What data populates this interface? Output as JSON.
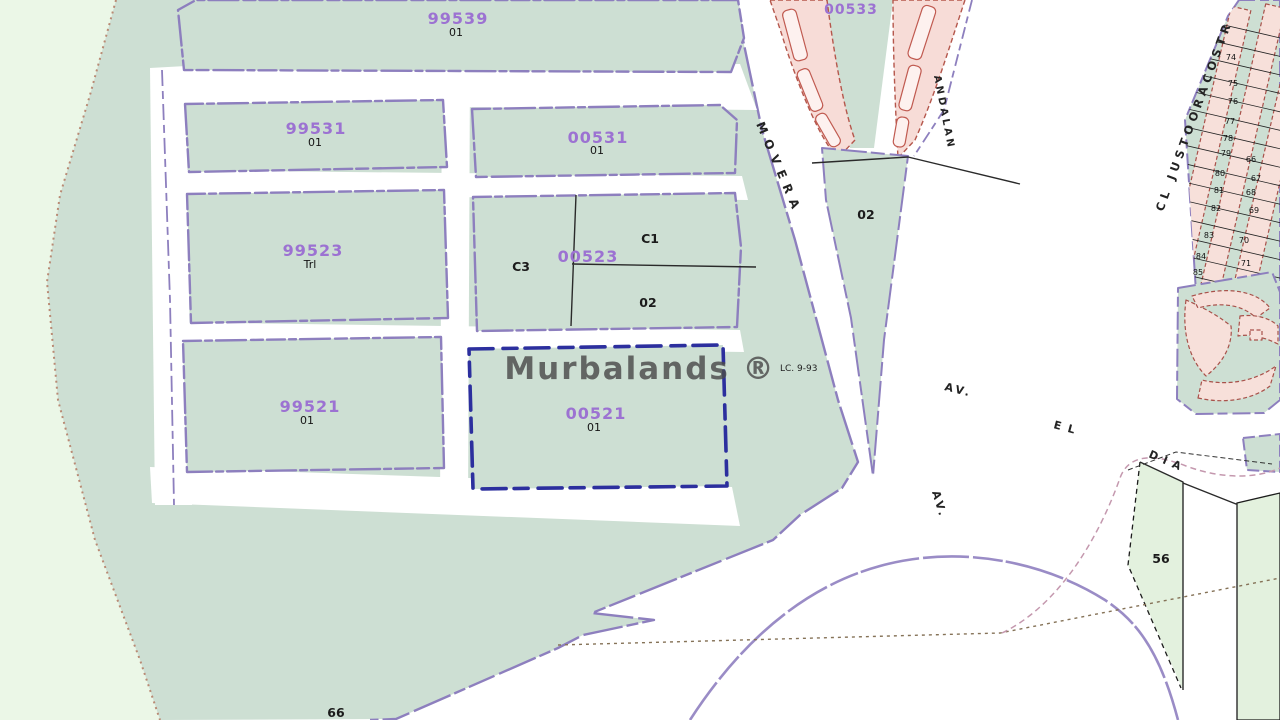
{
  "watermark": "Murbalands ®",
  "annotation": {
    "lc_note": "LC. 9-93"
  },
  "blocks": {
    "b99539": {
      "id": "99539",
      "sub": "01"
    },
    "b99531": {
      "id": "99531",
      "sub": "01"
    },
    "b00531": {
      "id": "00531",
      "sub": "01"
    },
    "b99523": {
      "id": "99523",
      "sub": "Trl"
    },
    "b00523": {
      "id": "00523",
      "parts": {
        "c1": "C1",
        "c3": "C3",
        "p02": "02"
      }
    },
    "b99521": {
      "id": "99521",
      "sub": "01"
    },
    "b00521": {
      "id": "00521",
      "sub": "01"
    },
    "b00533": {
      "id": "00533"
    }
  },
  "labels": {
    "wedge02": "02",
    "parcel56": "56",
    "parcel66": "66"
  },
  "streets": {
    "movera": "MOVERA",
    "andalan": "ANDALAN",
    "justo": "CL JUSTOORACOSTR",
    "av_upper": "AV.",
    "el": "EL",
    "dia": "DIA",
    "av_lower": "AV."
  },
  "grid_parcel_numbers": [
    {
      "t": "74",
      "x": 1231,
      "y": 60
    },
    {
      "t": "75",
      "x": 1233,
      "y": 86
    },
    {
      "t": "76",
      "x": 1233,
      "y": 104
    },
    {
      "t": "77",
      "x": 1230,
      "y": 124
    },
    {
      "t": "78",
      "x": 1228,
      "y": 141
    },
    {
      "t": "79",
      "x": 1226,
      "y": 156
    },
    {
      "t": "80",
      "x": 1220,
      "y": 176
    },
    {
      "t": "81",
      "x": 1219,
      "y": 193
    },
    {
      "t": "82",
      "x": 1216,
      "y": 211
    },
    {
      "t": "83",
      "x": 1209,
      "y": 238
    },
    {
      "t": "84",
      "x": 1201,
      "y": 259
    },
    {
      "t": "85",
      "x": 1198,
      "y": 275
    },
    {
      "t": "66",
      "x": 1251,
      "y": 162
    },
    {
      "t": "67",
      "x": 1256,
      "y": 181
    },
    {
      "t": "68",
      "x": 1251,
      "y": 195
    },
    {
      "t": "69",
      "x": 1254,
      "y": 213
    },
    {
      "t": "70",
      "x": 1244,
      "y": 243
    },
    {
      "t": "71",
      "x": 1246,
      "y": 266
    },
    {
      "t": "72",
      "x": 1239,
      "y": 286
    }
  ],
  "colors": {
    "parcel_fill": "#cddfd3",
    "pale_fill": "#ebf7e7",
    "light_fill": "#e3f1de",
    "boundary_purple": "#8d7fbe",
    "selected_blue": "#2c2f9e",
    "building_pink": "#f7dcd7",
    "building_outline": "#b5574c",
    "parcel_id_purple": "#9c72d2",
    "watermark_gray": "#4b4b4b"
  }
}
